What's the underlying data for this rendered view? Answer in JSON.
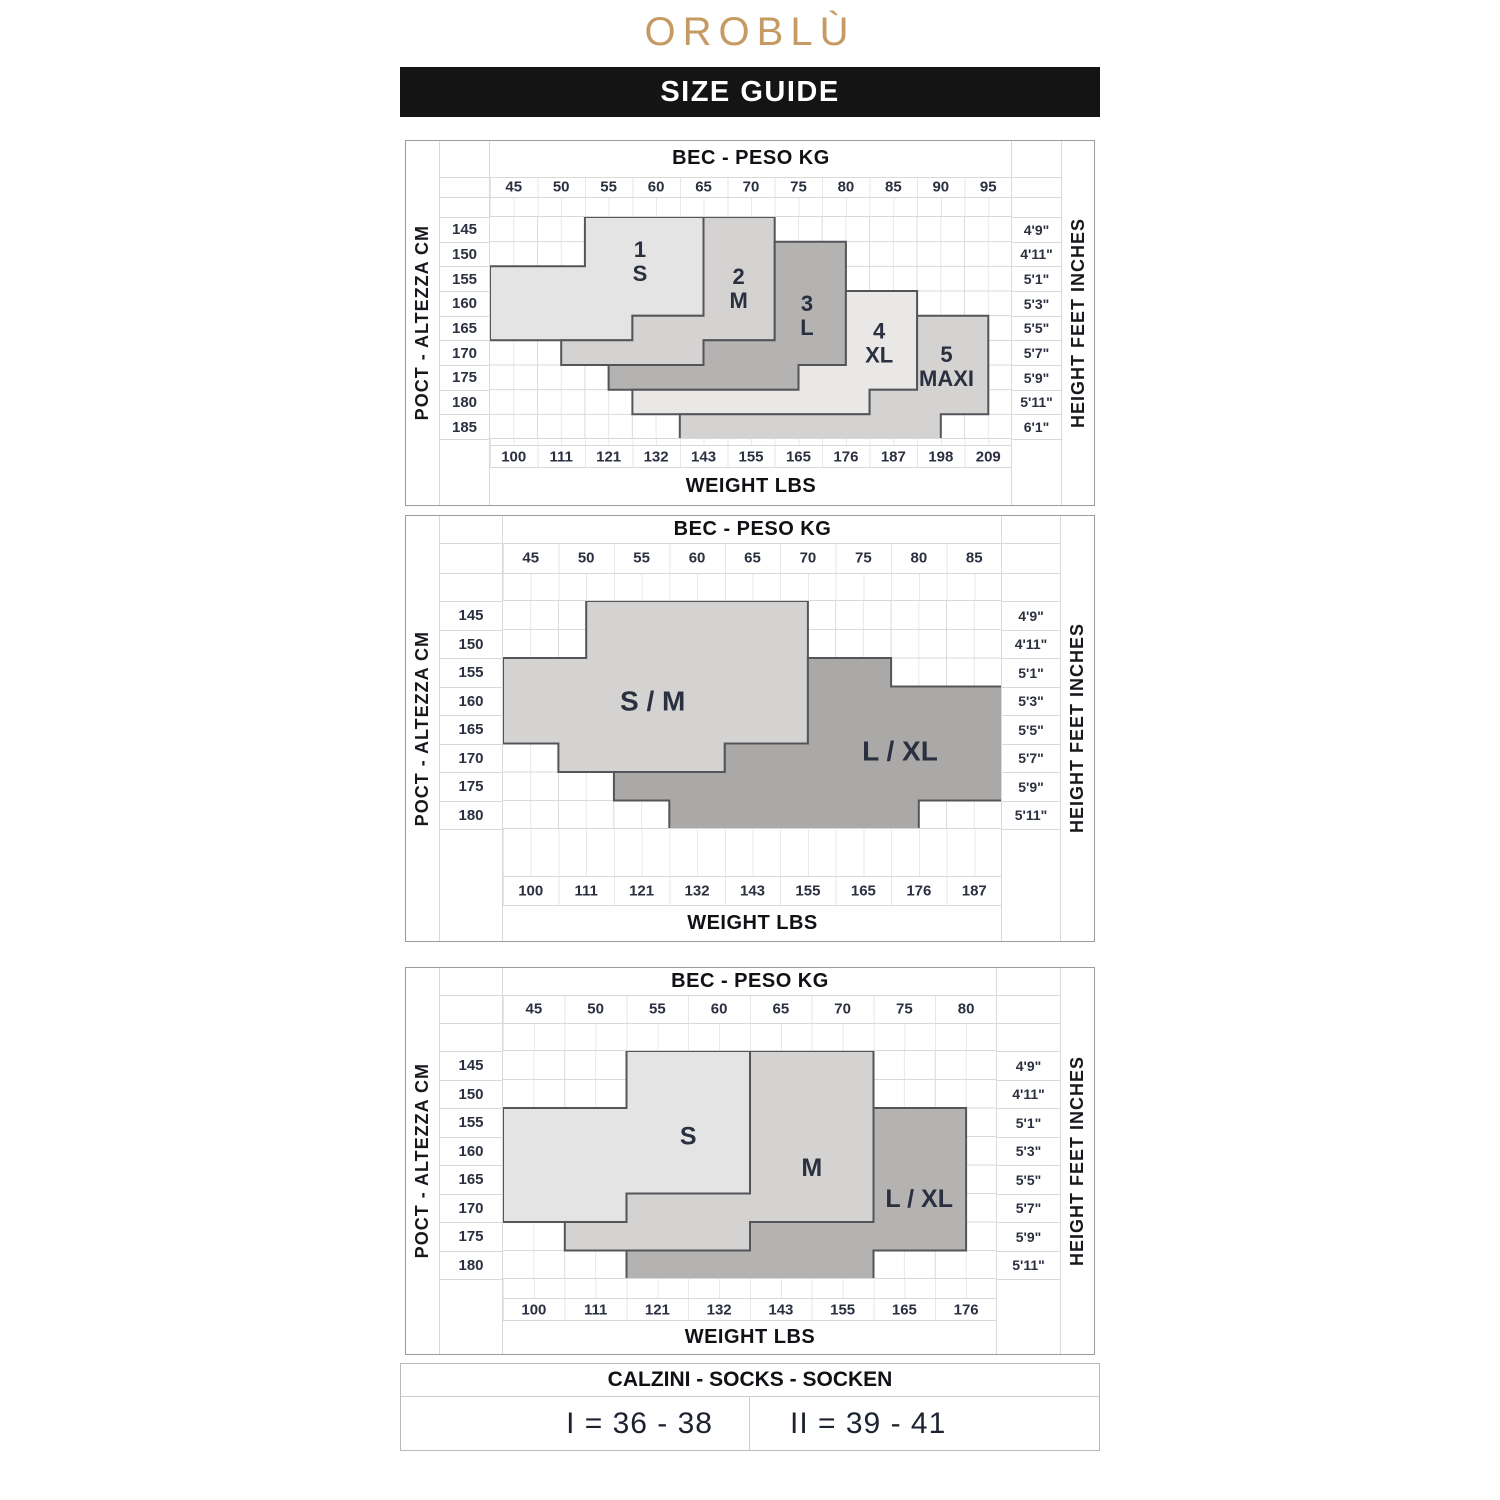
{
  "logo_text": "OROBLÙ",
  "banner_text": "SIZE GUIDE",
  "colors": {
    "logo_gold": "#c59b63",
    "banner_black": "#141414",
    "region_light": "#e4e4e4",
    "region_medium": "#d4d3d1",
    "region_dark": "#b4b3b1",
    "region_xlight": "#e9e8e7",
    "region_border": "#54555a",
    "text_dark": "#2b3040"
  },
  "chart_data": [
    {
      "type": "area",
      "title": "BEC - PESO KG",
      "left_axis_label": "POCT - ALTEZZA CM",
      "right_axis_label": "HEIGHT FEET INCHES",
      "bottom_axis_label": "WEIGHT LBS",
      "kg_ticks": [
        45,
        50,
        55,
        60,
        65,
        70,
        75,
        80,
        85,
        90,
        95
      ],
      "lbs_ticks": [
        100,
        111,
        121,
        132,
        143,
        155,
        165,
        176,
        187,
        198,
        209
      ],
      "cm_ticks": [
        145,
        150,
        155,
        160,
        165,
        170,
        175,
        180,
        185
      ],
      "feet_ticks": [
        "4'9\"",
        "4'11\"",
        "5'1\"",
        "5'3\"",
        "5'5\"",
        "5'7\"",
        "5'9\"",
        "5'11\"",
        "6'1\""
      ],
      "kg_range": [
        42.5,
        97.5
      ],
      "cm_range": [
        142.5,
        187.5
      ],
      "label_font": 22,
      "regions": [
        {
          "name": "size-1-s",
          "label_lines": [
            "1",
            "S"
          ],
          "label_pos": [
            58.3,
            151.5
          ],
          "color": "#e4e4e4",
          "points": [
            [
              52.5,
              142.5
            ],
            [
              65,
              142.5
            ],
            [
              65,
              162.5
            ],
            [
              57.5,
              162.5
            ],
            [
              57.5,
              167.5
            ],
            [
              42.5,
              167.5
            ],
            [
              42.5,
              152.5
            ],
            [
              52.5,
              152.5
            ]
          ]
        },
        {
          "name": "size-2-m",
          "label_lines": [
            "2",
            "M"
          ],
          "label_pos": [
            68.7,
            157
          ],
          "color": "#d4d3d1",
          "points": [
            [
              65,
              142.5
            ],
            [
              72.5,
              142.5
            ],
            [
              72.5,
              167.5
            ],
            [
              65,
              167.5
            ],
            [
              65,
              172.5
            ],
            [
              50,
              172.5
            ],
            [
              50,
              167.5
            ],
            [
              57.5,
              167.5
            ],
            [
              57.5,
              162.5
            ],
            [
              65,
              162.5
            ]
          ]
        },
        {
          "name": "size-3-l",
          "label_lines": [
            "3",
            "L"
          ],
          "label_pos": [
            75.9,
            162.5
          ],
          "color": "#b4b3b1",
          "points": [
            [
              72.5,
              147.5
            ],
            [
              80,
              147.5
            ],
            [
              80,
              172.5
            ],
            [
              75,
              172.5
            ],
            [
              75,
              177.5
            ],
            [
              55,
              177.5
            ],
            [
              55,
              172.5
            ],
            [
              65,
              172.5
            ],
            [
              65,
              167.5
            ],
            [
              72.5,
              167.5
            ]
          ]
        },
        {
          "name": "size-4-xl",
          "label_lines": [
            "4",
            "XL"
          ],
          "label_pos": [
            83.5,
            168
          ],
          "color": "#e9e8e7",
          "points": [
            [
              80,
              157.5
            ],
            [
              87.5,
              157.5
            ],
            [
              87.5,
              177.5
            ],
            [
              82.5,
              177.5
            ],
            [
              82.5,
              182.5
            ],
            [
              57.5,
              182.5
            ],
            [
              57.5,
              177.5
            ],
            [
              75,
              177.5
            ],
            [
              75,
              172.5
            ],
            [
              80,
              172.5
            ]
          ]
        },
        {
          "name": "size-5-maxi",
          "label_lines": [
            "5",
            "MAXI"
          ],
          "label_pos": [
            90.6,
            172.8
          ],
          "color": "#d4d3d1",
          "points": [
            [
              87.5,
              162.5
            ],
            [
              95,
              162.5
            ],
            [
              95,
              182.5
            ],
            [
              90,
              182.5
            ],
            [
              90,
              187.5
            ],
            [
              62.5,
              187.5
            ],
            [
              62.5,
              182.5
            ],
            [
              82.5,
              182.5
            ],
            [
              82.5,
              177.5
            ],
            [
              87.5,
              177.5
            ]
          ]
        }
      ]
    },
    {
      "type": "area",
      "title": "BEC - PESO KG",
      "left_axis_label": "POCT - ALTEZZA CM",
      "right_axis_label": "HEIGHT FEET INCHES",
      "bottom_axis_label": "WEIGHT LBS",
      "kg_ticks": [
        45,
        50,
        55,
        60,
        65,
        70,
        75,
        80,
        85
      ],
      "lbs_ticks": [
        100,
        111,
        121,
        132,
        143,
        155,
        165,
        176,
        187
      ],
      "cm_ticks": [
        145,
        150,
        155,
        160,
        165,
        170,
        175,
        180
      ],
      "feet_ticks": [
        "4'9\"",
        "4'11\"",
        "5'1\"",
        "5'3\"",
        "5'5\"",
        "5'7\"",
        "5'9\"",
        "5'11\""
      ],
      "kg_range": [
        42.5,
        87.5
      ],
      "cm_range": [
        142.5,
        182.5
      ],
      "label_font": 28,
      "regions": [
        {
          "name": "size-s-m",
          "label_lines": [
            "S / M"
          ],
          "label_pos": [
            56,
            160
          ],
          "color": "#d4d3d1",
          "points": [
            [
              50,
              142.5
            ],
            [
              70,
              142.5
            ],
            [
              70,
              167.5
            ],
            [
              62.5,
              167.5
            ],
            [
              62.5,
              172.5
            ],
            [
              47.5,
              172.5
            ],
            [
              47.5,
              167.5
            ],
            [
              42.5,
              167.5
            ],
            [
              42.5,
              152.5
            ],
            [
              50,
              152.5
            ]
          ]
        },
        {
          "name": "size-l-xl",
          "label_lines": [
            "L / XL"
          ],
          "label_pos": [
            78.3,
            168.8
          ],
          "color": "#aaa9a7",
          "points": [
            [
              70,
              152.5
            ],
            [
              77.5,
              152.5
            ],
            [
              77.5,
              157.5
            ],
            [
              87.5,
              157.5
            ],
            [
              87.5,
              177.5
            ],
            [
              80,
              177.5
            ],
            [
              80,
              182.5
            ],
            [
              57.5,
              182.5
            ],
            [
              57.5,
              177.5
            ],
            [
              52.5,
              177.5
            ],
            [
              52.5,
              172.5
            ],
            [
              62.5,
              172.5
            ],
            [
              62.5,
              167.5
            ],
            [
              70,
              167.5
            ]
          ]
        }
      ]
    },
    {
      "type": "area",
      "title": "BEC - PESO KG",
      "left_axis_label": "POCT - ALTEZZA CM",
      "right_axis_label": "HEIGHT FEET INCHES",
      "bottom_axis_label": "WEIGHT LBS",
      "kg_ticks": [
        45,
        50,
        55,
        60,
        65,
        70,
        75,
        80
      ],
      "lbs_ticks": [
        100,
        111,
        121,
        132,
        143,
        155,
        165,
        176
      ],
      "cm_ticks": [
        145,
        150,
        155,
        160,
        165,
        170,
        175,
        180
      ],
      "feet_ticks": [
        "4'9\"",
        "4'11\"",
        "5'1\"",
        "5'3\"",
        "5'5\"",
        "5'7\"",
        "5'9\"",
        "5'11\""
      ],
      "kg_range": [
        42.5,
        82.5
      ],
      "cm_range": [
        142.5,
        182.5
      ],
      "label_font": 25,
      "regions": [
        {
          "name": "size-s",
          "label_lines": [
            "S"
          ],
          "label_pos": [
            57.5,
            157.5
          ],
          "color": "#e4e4e4",
          "points": [
            [
              52.5,
              142.5
            ],
            [
              62.5,
              142.5
            ],
            [
              62.5,
              167.5
            ],
            [
              52.5,
              167.5
            ],
            [
              52.5,
              172.5
            ],
            [
              42.5,
              172.5
            ],
            [
              42.5,
              152.5
            ],
            [
              52.5,
              152.5
            ]
          ]
        },
        {
          "name": "size-m",
          "label_lines": [
            "M"
          ],
          "label_pos": [
            67.5,
            163
          ],
          "color": "#d4d3d1",
          "points": [
            [
              62.5,
              142.5
            ],
            [
              72.5,
              142.5
            ],
            [
              72.5,
              172.5
            ],
            [
              62.5,
              172.5
            ],
            [
              62.5,
              177.5
            ],
            [
              47.5,
              177.5
            ],
            [
              47.5,
              172.5
            ],
            [
              52.5,
              172.5
            ],
            [
              52.5,
              167.5
            ],
            [
              62.5,
              167.5
            ]
          ]
        },
        {
          "name": "size-l-xl",
          "label_lines": [
            "L / XL"
          ],
          "label_pos": [
            76.2,
            168.5
          ],
          "color": "#b4b3b1",
          "points": [
            [
              72.5,
              152.5
            ],
            [
              80,
              152.5
            ],
            [
              80,
              177.5
            ],
            [
              72.5,
              177.5
            ],
            [
              72.5,
              182.5
            ],
            [
              52.5,
              182.5
            ],
            [
              52.5,
              177.5
            ],
            [
              62.5,
              177.5
            ],
            [
              62.5,
              172.5
            ],
            [
              72.5,
              172.5
            ]
          ]
        }
      ]
    }
  ],
  "socks_table": {
    "title": "CALZINI - SOCKS - SOCKEN",
    "cell_1": "I = 36 - 38",
    "cell_2": "II = 39 - 41"
  }
}
